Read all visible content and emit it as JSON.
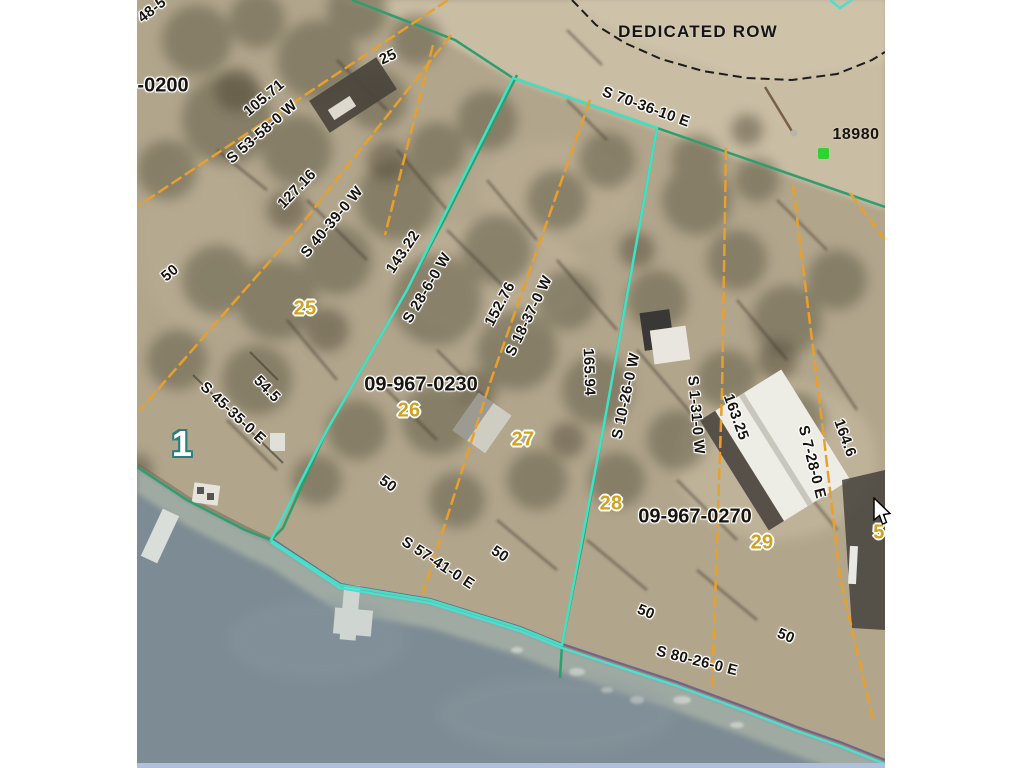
{
  "page": {
    "background": "#ffffff"
  },
  "map": {
    "description_colors": {
      "land_tan": "#b1a58c",
      "gravel_road": "#c9bda4",
      "water_gray": "#7d8c94",
      "beach_sand": "#a8b2a6",
      "orange_lot_line": "#e8a02c",
      "green_boundary_line": "#2f9e6e",
      "cyan_selected_parcel": "#3fe2c5",
      "purple_shore_line": "#6c5a96",
      "black_row_line": "#1c1c1c",
      "yellow_lot_number": "#cfa11c",
      "green_point_marker": "#2fd32f",
      "bottom_edge_strip": "#b2bfdc"
    },
    "labels": [
      {
        "text": "48-5",
        "x": 15,
        "y": 10,
        "rot": -38,
        "cls": "bearing"
      },
      {
        "text": "-0200",
        "x": 26,
        "y": 86,
        "rot": 0,
        "cls": "parcel-id"
      },
      {
        "text": "105.71",
        "x": 127,
        "y": 98,
        "rot": -40,
        "cls": "distance"
      },
      {
        "text": "S 53-58-0 W",
        "x": 125,
        "y": 132,
        "rot": -41,
        "cls": "bearing"
      },
      {
        "text": "25",
        "x": 251,
        "y": 57,
        "rot": -25,
        "cls": "distance"
      },
      {
        "text": "127.16",
        "x": 160,
        "y": 189,
        "rot": -46,
        "cls": "distance"
      },
      {
        "text": "S 40-39-0 W",
        "x": 195,
        "y": 222,
        "rot": -50,
        "cls": "bearing"
      },
      {
        "text": "50",
        "x": 33,
        "y": 273,
        "rot": -40,
        "cls": "distance"
      },
      {
        "text": "143.22",
        "x": 266,
        "y": 252,
        "rot": -56,
        "cls": "distance"
      },
      {
        "text": "S 28-6-0 W",
        "x": 290,
        "y": 288,
        "rot": -59,
        "cls": "bearing"
      },
      {
        "text": "152.76",
        "x": 363,
        "y": 304,
        "rot": -62,
        "cls": "distance"
      },
      {
        "text": "S 18-37-0 W",
        "x": 392,
        "y": 316,
        "rot": -64,
        "cls": "bearing"
      },
      {
        "text": "165.94",
        "x": 452,
        "y": 372,
        "rot": 88,
        "cls": "distance"
      },
      {
        "text": "S 10-26-0 W",
        "x": 489,
        "y": 396,
        "rot": -78,
        "cls": "bearing"
      },
      {
        "text": "S 1-31-0 W",
        "x": 559,
        "y": 415,
        "rot": 85,
        "cls": "bearing"
      },
      {
        "text": "163.25",
        "x": 599,
        "y": 417,
        "rot": 70,
        "cls": "distance"
      },
      {
        "text": "S 7-28-0 E",
        "x": 675,
        "y": 462,
        "rot": 76,
        "cls": "bearing"
      },
      {
        "text": "164.6",
        "x": 708,
        "y": 438,
        "rot": 70,
        "cls": "distance"
      },
      {
        "text": "S 70-36-10 E",
        "x": 509,
        "y": 107,
        "rot": 20,
        "cls": "bearing"
      },
      {
        "text": "DEDICATED ROW",
        "x": 561,
        "y": 32,
        "rot": 0,
        "cls": "row-label"
      },
      {
        "text": "18980",
        "x": 719,
        "y": 135,
        "rot": 0,
        "cls": "address"
      },
      {
        "text": "09-967-0230",
        "x": 284,
        "y": 385,
        "rot": 0,
        "cls": "parcel-id"
      },
      {
        "text": "09-967-0270",
        "x": 558,
        "y": 517,
        "rot": 0,
        "cls": "parcel-id"
      },
      {
        "text": "S 45-35-0 E",
        "x": 96,
        "y": 413,
        "rot": 43,
        "cls": "bearing"
      },
      {
        "text": "54.5",
        "x": 130,
        "y": 389,
        "rot": 45,
        "cls": "distance"
      },
      {
        "text": "S 57-41-0 E",
        "x": 301,
        "y": 563,
        "rot": 33,
        "cls": "bearing"
      },
      {
        "text": "50",
        "x": 251,
        "y": 484,
        "rot": 35,
        "cls": "distance"
      },
      {
        "text": "50",
        "x": 363,
        "y": 554,
        "rot": 33,
        "cls": "distance"
      },
      {
        "text": "50",
        "x": 509,
        "y": 612,
        "rot": 22,
        "cls": "distance"
      },
      {
        "text": "50",
        "x": 649,
        "y": 636,
        "rot": 22,
        "cls": "distance"
      },
      {
        "text": "S 80-26-0 E",
        "x": 560,
        "y": 661,
        "rot": 14,
        "cls": "bearing"
      },
      {
        "text": "25",
        "x": 168,
        "y": 309,
        "rot": 0,
        "cls": "lot"
      },
      {
        "text": "26",
        "x": 272,
        "y": 411,
        "rot": 0,
        "cls": "lot"
      },
      {
        "text": "27",
        "x": 386,
        "y": 440,
        "rot": 0,
        "cls": "lot"
      },
      {
        "text": "28",
        "x": 474,
        "y": 504,
        "rot": 0,
        "cls": "lot"
      },
      {
        "text": "29",
        "x": 625,
        "y": 543,
        "rot": 0,
        "cls": "lot"
      },
      {
        "text": "5",
        "x": 742,
        "y": 533,
        "rot": 0,
        "cls": "lot"
      },
      {
        "text": "1",
        "x": 45,
        "y": 444,
        "rot": 0,
        "cls": "outlot"
      }
    ],
    "lines": [
      {
        "name": "row-edge-black",
        "color": "#1c1c1c",
        "width": 2,
        "dash": "9 5",
        "points": "435,0 459,25 488,43 524,59 566,71 610,78 655,80 700,74 735,60 748,52"
      },
      {
        "name": "green-road-boundary",
        "color": "#2f9e6e",
        "width": 2.5,
        "points": "215,0 318,40 376,78 520,128 748,207"
      },
      {
        "name": "green-lot-line-143",
        "color": "#2f9e6e",
        "width": 2.5,
        "points": "380,75 308,218 270,290 190,430 146,528 134,540"
      },
      {
        "name": "green-lot-line-165",
        "color": "#2f9e6e",
        "width": 2.5,
        "points": "520,128 489,300 466,430 446,540 425,645 423,678"
      },
      {
        "name": "green-shore-left",
        "color": "#2f9e6e",
        "width": 2.5,
        "points": "0,467 50,500 108,530 134,540"
      },
      {
        "name": "purple-lake-edge",
        "color": "#6c5a96",
        "width": 2,
        "opacity": ".8",
        "points": "134,538 203,584 293,599 383,627 425,644 470,659 540,682 608,707 660,727 703,742 748,760"
      },
      {
        "name": "cyan-lake-edge",
        "color": "#49dfd3",
        "width": 2.5,
        "points": "134,542 203,588 293,603 383,631 425,648 470,663 540,686 608,711 660,731 703,746 748,764"
      },
      {
        "name": "cyan-selected-parcel",
        "color": "#3fe2c5",
        "width": 2.5,
        "closed": true,
        "points": "376,78 520,128 466,430 425,645 383,628 293,600 203,585 134,540 190,430 270,290"
      },
      {
        "name": "orange-lot-line-1",
        "color": "#e8a02c",
        "width": 2.5,
        "dash": "12 4",
        "points": "311,0 1,206"
      },
      {
        "name": "orange-lot-line-2",
        "color": "#e8a02c",
        "width": 2.5,
        "dash": "12 4",
        "points": "314,35 160,230 3,410"
      },
      {
        "name": "orange-lot-line-2b",
        "color": "#e8a02c",
        "width": 2.5,
        "dash": "12 4",
        "points": "296,45 248,235"
      },
      {
        "name": "orange-lot-line-3",
        "color": "#e8a02c",
        "width": 2.5,
        "dash": "12 4",
        "points": "453,100 353,383 286,593"
      },
      {
        "name": "orange-lot-line-4",
        "color": "#e8a02c",
        "width": 2.5,
        "dash": "12 4",
        "points": "589,148 585,393 575,690"
      },
      {
        "name": "orange-lot-line-5",
        "color": "#e8a02c",
        "width": 2.5,
        "dash": "12 4",
        "points": "656,185 686,430 703,577 736,720"
      },
      {
        "name": "orange-lot-line-6",
        "color": "#e8a02c",
        "width": 2.5,
        "dash": "12 4",
        "points": "713,193 748,240"
      },
      {
        "name": "dark-path-1",
        "color": "#4a4434",
        "width": 2,
        "opacity": ".7",
        "points": "56,375 146,463"
      },
      {
        "name": "dark-path-2",
        "color": "#4a4434",
        "width": 2,
        "opacity": ".7",
        "points": "113,352 141,380"
      }
    ],
    "marker": {
      "name": "green-square-point",
      "x": 681,
      "y": 148,
      "color": "#2fd32f"
    },
    "cursor": {
      "x": 873,
      "y": 497
    }
  }
}
